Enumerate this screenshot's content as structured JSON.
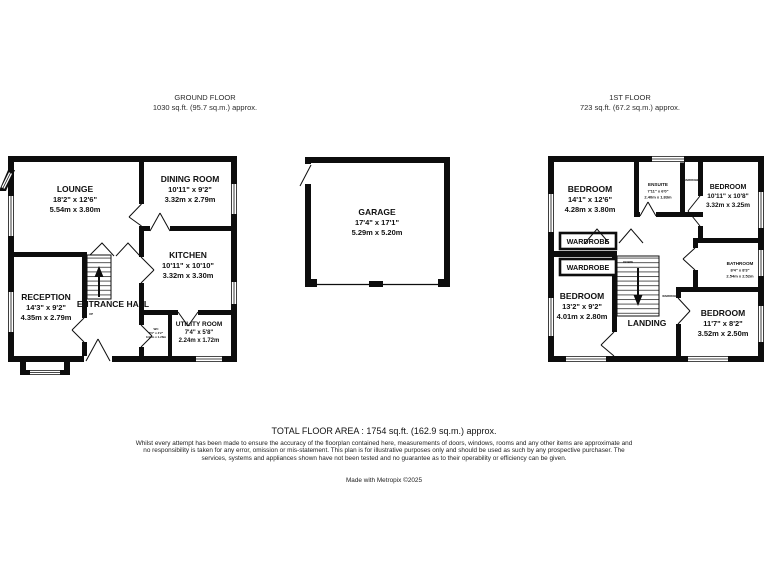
{
  "headers": {
    "ground": {
      "title": "GROUND FLOOR",
      "area": "1030 sq.ft. (95.7 sq.m.) approx."
    },
    "first": {
      "title": "1ST FLOOR",
      "area": "723 sq.ft. (67.2 sq.m.) approx."
    }
  },
  "ground_floor": {
    "lounge": {
      "name": "LOUNGE",
      "imperial": "18'2\" x 12'6\"",
      "metric": "5.54m x 3.80m"
    },
    "dining_room": {
      "name": "DINING ROOM",
      "imperial": "10'11\" x 9'2\"",
      "metric": "3.32m x 2.79m"
    },
    "kitchen": {
      "name": "KITCHEN",
      "imperial": "10'11\" x 10'10\"",
      "metric": "3.32m x 3.30m"
    },
    "reception": {
      "name": "RECEPTION",
      "imperial": "14'3\" x 9'2\"",
      "metric": "4.35m x 2.79m"
    },
    "entrance_hall": {
      "name": "ENTRANCE HALL",
      "up": "UP"
    },
    "utility_room": {
      "name": "UTILITY ROOM",
      "imperial": "7'4\" x 5'8\"",
      "metric": "2.24m x 1.72m"
    },
    "wc": {
      "name": "WC",
      "imperial": "3'0\" x 4'2\"",
      "metric": "0.91m x 1.28m"
    }
  },
  "garage": {
    "name": "GARAGE",
    "imperial": "17'4\" x 17'1\"",
    "metric": "5.29m x 5.20m"
  },
  "first_floor": {
    "bedroom1": {
      "name": "BEDROOM",
      "imperial": "14'1\" x 12'6\"",
      "metric": "4.28m x 3.80m"
    },
    "ensuite": {
      "name": "ENSUITE",
      "imperial": "7'11\" x 6'0\"",
      "metric": "2.40m x 1.83m"
    },
    "bedroom2": {
      "name": "BEDROOM",
      "imperial": "10'11\" x 10'8\"",
      "metric": "3.32m x 3.25m"
    },
    "wardrobe_top": {
      "name": "WARDROBE"
    },
    "wardrobe1": {
      "name": "WARDROBE"
    },
    "wardrobe2": {
      "name": "WARDROBE"
    },
    "bathroom": {
      "name": "BATHROOM",
      "imperial": "8'4\" x 8'3\"",
      "metric": "2.54m x 2.52m"
    },
    "bedroom3": {
      "name": "BEDROOM",
      "imperial": "13'2\" x 9'2\"",
      "metric": "4.01m x 2.80m"
    },
    "landing": {
      "name": "LANDING",
      "down": "DOWN"
    },
    "bedroom4": {
      "name": "BEDROOM",
      "imperial": "11'7\" x 8'2\"",
      "metric": "3.52m x 2.50m"
    },
    "wardrobe_side": {
      "name": "WARDROBE"
    }
  },
  "footer": {
    "total": "TOTAL FLOOR AREA : 1754 sq.ft. (162.9 sq.m.) approx.",
    "disclaimer": "Whilst every attempt has been made to ensure the accuracy of the floorplan contained here, measurements of doors, windows, rooms and any other items are approximate and no responsibility is taken for any error, omission or mis-statement. This plan is for illustrative purposes only and should be used as such by any prospective purchaser. The services, systems and appliances shown have not been tested and no guarantee as to their operability or efficiency can be given.",
    "credit": "Made with Metropix ©2025"
  },
  "colors": {
    "wall": "#0d0d0d",
    "text": "#111111"
  }
}
